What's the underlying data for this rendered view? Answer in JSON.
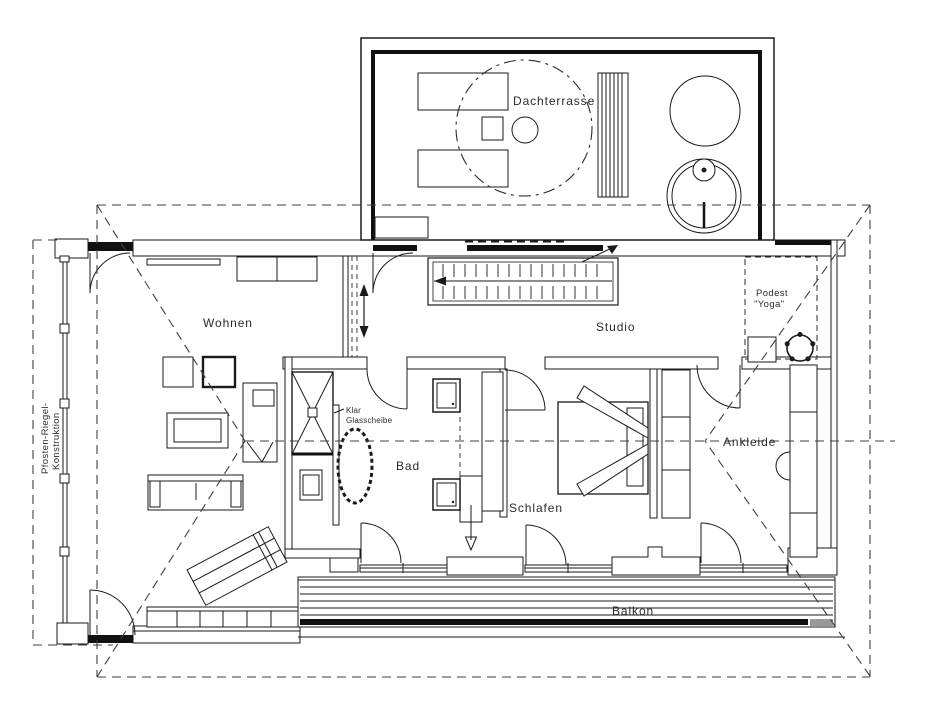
{
  "plan": {
    "rooms": {
      "dachterrasse": "Dachterrasse",
      "wohnen": "Wohnen",
      "studio": "Studio",
      "bad": "Bad",
      "schlafen": "Schlafen",
      "ankleide": "Ankleide",
      "balkon": "Balkon"
    },
    "annotations": {
      "podest_line1": "Podest",
      "podest_line2": "\"Yoga\"",
      "glass_line1": "Klar",
      "glass_line2": "Glasscheibe",
      "facade_line1": "Pfosten-Riegel-",
      "facade_line2": "Konstruktion"
    },
    "colors": {
      "line": "#1a1a1a",
      "dashed": "#3f3f3f",
      "background": "#ffffff",
      "accent_gray": "#999999"
    }
  }
}
